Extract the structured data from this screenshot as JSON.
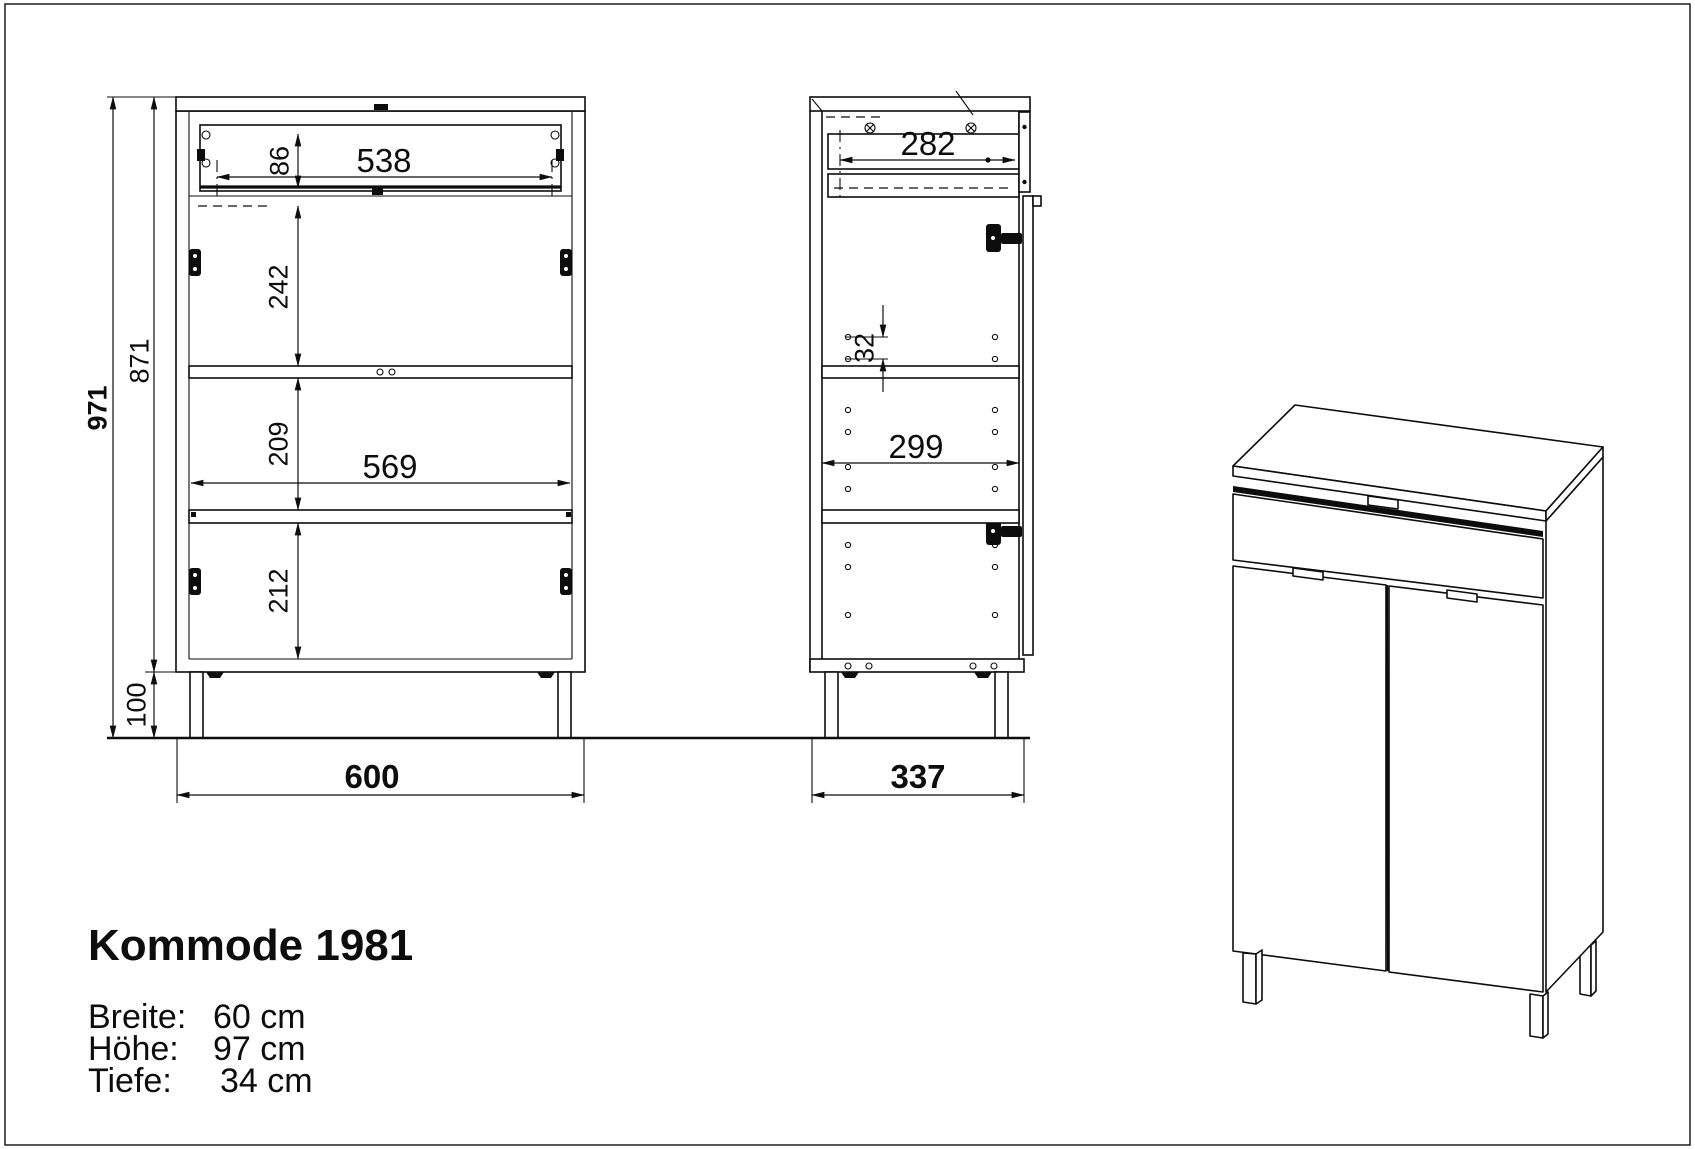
{
  "title": "Kommode 1981",
  "specs": {
    "rows": [
      {
        "label": "Breite:",
        "value": "60 cm"
      },
      {
        "label": "Höhe:",
        "value": "97 cm"
      },
      {
        "label": "Tiefe:",
        "value": "34 cm"
      }
    ]
  },
  "front_view": {
    "total_height": "971",
    "body_height": "871",
    "leg_height": "100",
    "width": "600",
    "drawer_front_height": "86",
    "drawer_width": "538",
    "section_top": "242",
    "section_middle": "209",
    "interior_width": "569",
    "section_bottom": "212"
  },
  "side_view": {
    "drawer_depth": "282",
    "pin_spacing": "32",
    "interior_depth": "299",
    "depth": "337"
  },
  "colors": {
    "line": "#0d0d0d",
    "background": "#ffffff"
  }
}
